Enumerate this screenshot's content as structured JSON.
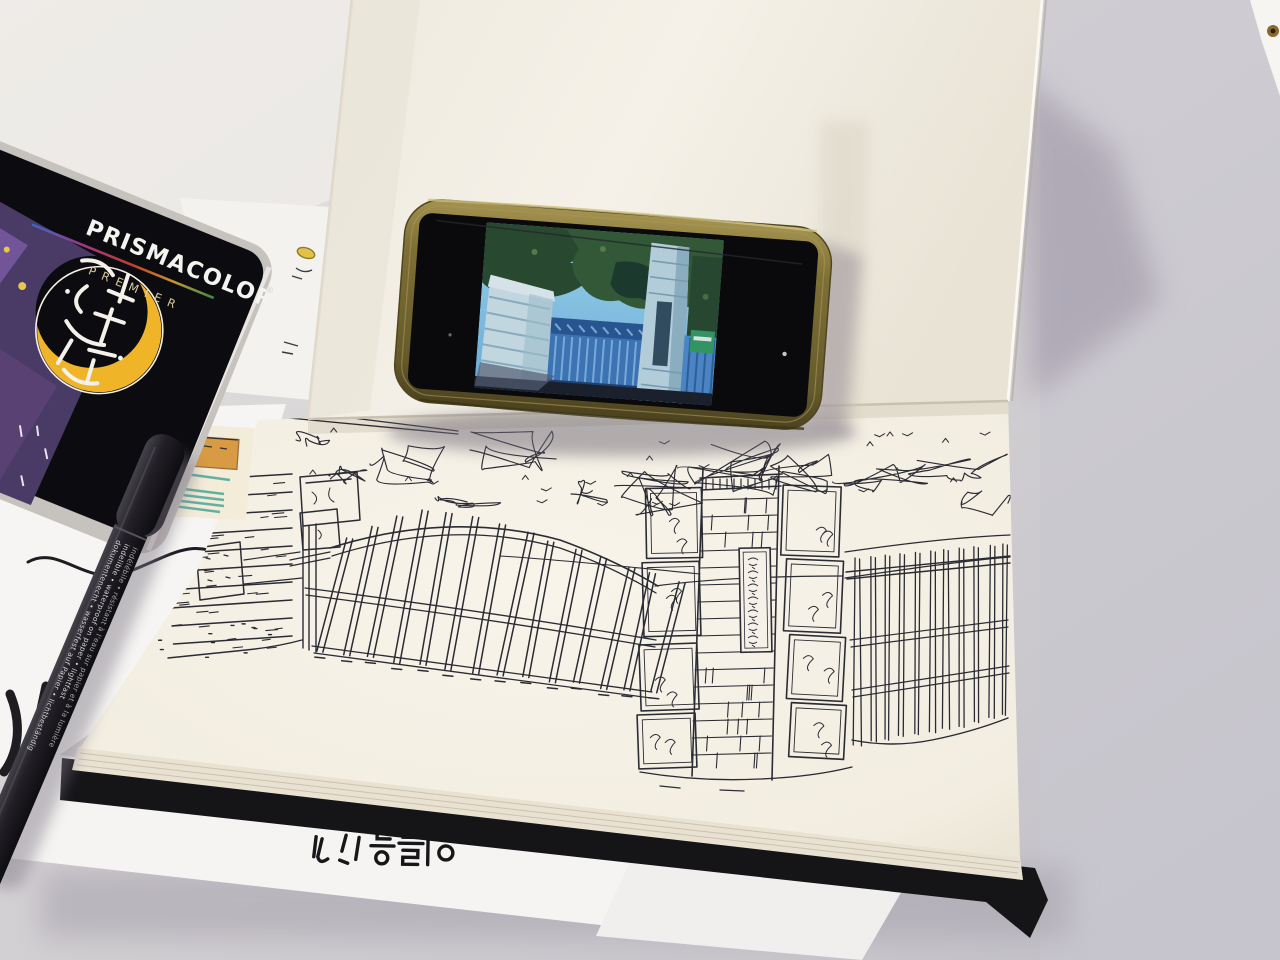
{
  "scene": {
    "setting": "photograph of an open sketchbook on a gray desk: ink sketch of a school gate, smartphone propped on the cover showing the reference photo, Prismacolor pencil tin and a black fineliner pen"
  },
  "prismacolor_tin": {
    "brand": "PRISMACOLOR",
    "registered_mark": "®",
    "series": "PREMIER",
    "sticker_calligraphy_korean": "감성일기",
    "tin_black": "#0c0c10",
    "rim_silver": "#c6c2be",
    "crescent_yellow": "#f0b429"
  },
  "phone": {
    "case_color": "#7a6c34",
    "photo_subject": "stone gate pillars with blue metal gate, trees and sky"
  },
  "sketchbook": {
    "page_color": "#f5f1e8",
    "ink_color": "#2b2b34",
    "pillar_sign_korean": "학교법인 성신학원"
  },
  "pen": {
    "label_de": "dokumentenecht • wasserfest auf Papier • lichtbeständig",
    "label_en": "indelible • waterproof on paper • lightfast",
    "label_fr": "indélébile • résistant à l'eau sur papier et à la lumière"
  },
  "loose_note": {
    "handwriting_korean": "이름을"
  }
}
